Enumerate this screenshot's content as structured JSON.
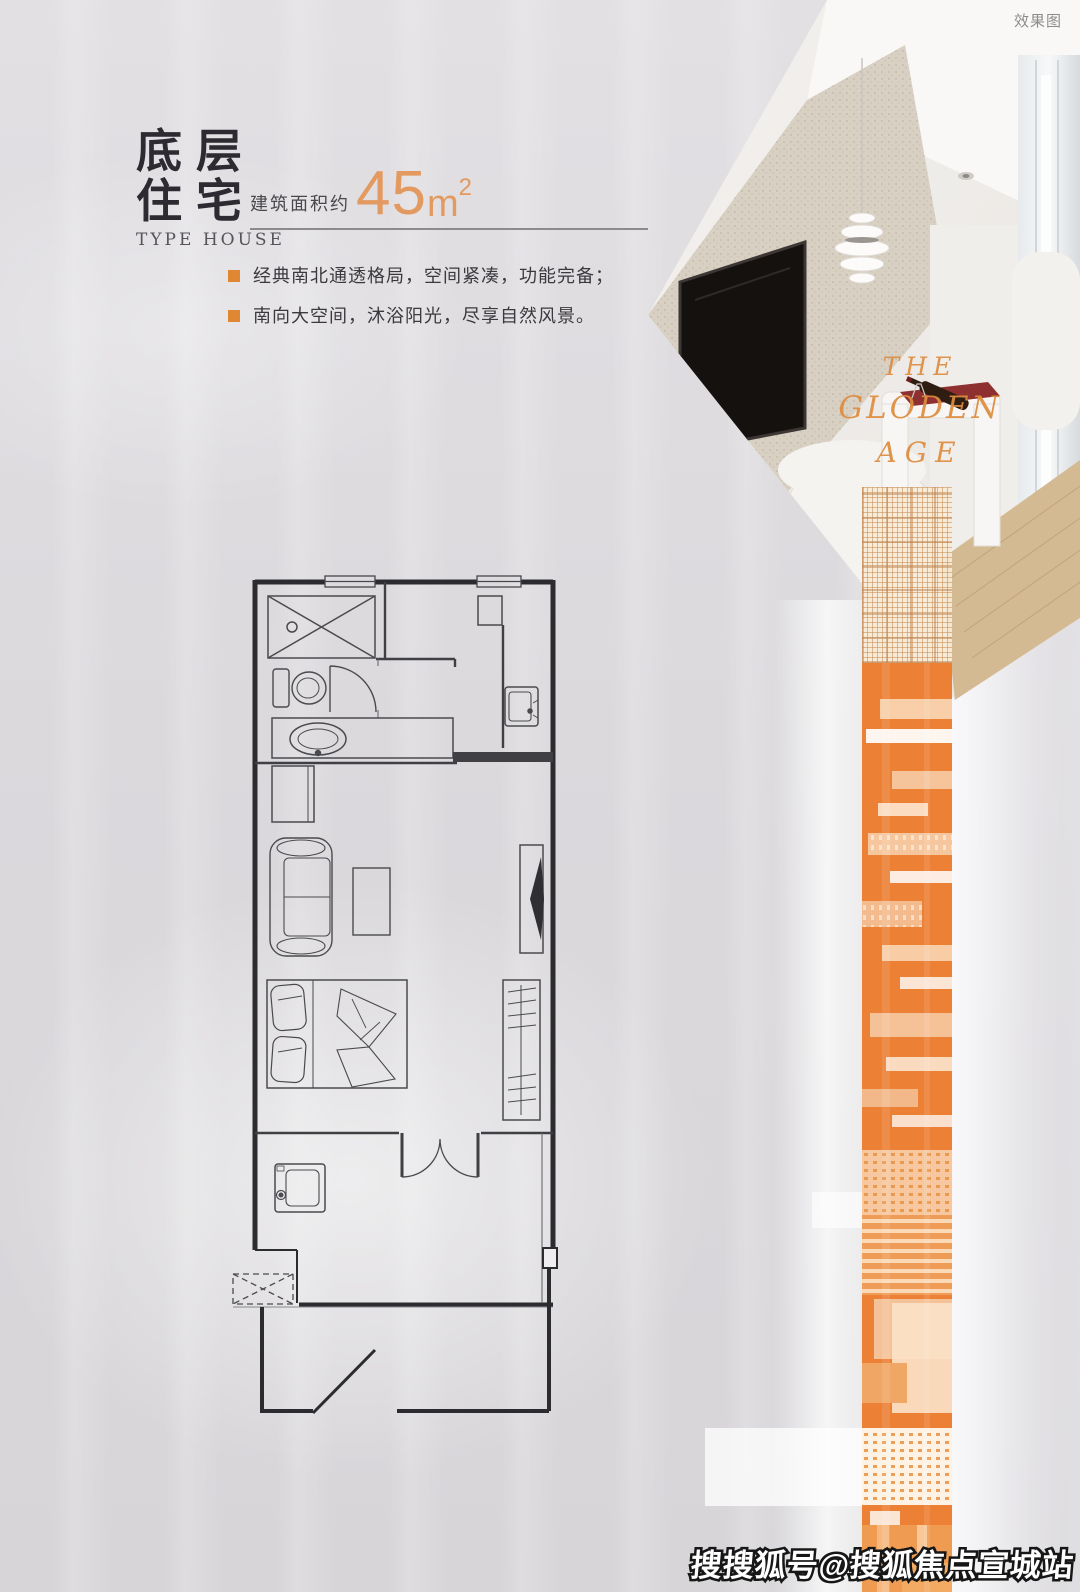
{
  "page": {
    "render_label": "效果图",
    "watermark": "搜搜狐号@搜狐焦点宣城站"
  },
  "header": {
    "title_line1": "底层",
    "title_line2": "住宅",
    "subtitle": "TYPE HOUSE",
    "area_prefix": "建筑面积约",
    "area_value": "45",
    "area_unit": "m",
    "area_sup": "2"
  },
  "features": [
    "经典南北通透格局，空间紧凑，功能完备；",
    "南向大空间，沐浴阳光，尽享自然风景。"
  ],
  "photo": {
    "overlay_line1": "THE",
    "overlay_line2": "GLODEN",
    "overlay_line3": "AGE"
  },
  "colors": {
    "accent": "#e29a60",
    "accent-strong": "#df8733",
    "band-orange": "#ec8136",
    "title-ink": "#2d2b31",
    "feature-text": "#3b393d",
    "watermark-fill": "#ffffff"
  }
}
